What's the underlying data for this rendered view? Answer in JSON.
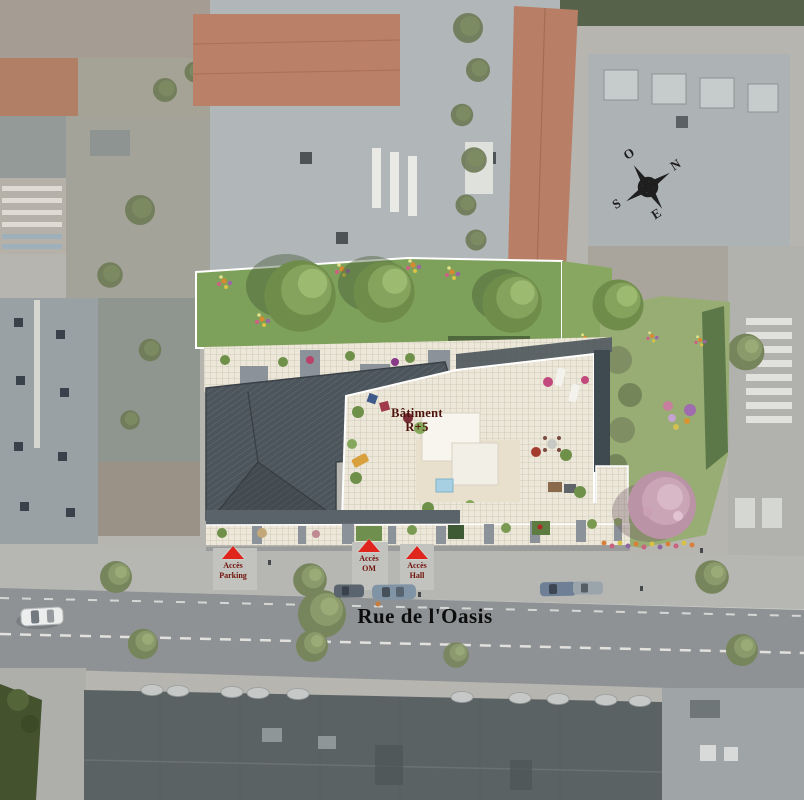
{
  "plan": {
    "building": {
      "label_line1": "Bâtiment",
      "label_line2": "R+5"
    },
    "street": {
      "name": "Rue de l'Oasis"
    },
    "access_points": [
      {
        "id": "parking",
        "line1": "Accès",
        "line2": "Parking"
      },
      {
        "id": "om",
        "line1": "Accès",
        "line2": "OM"
      },
      {
        "id": "hall",
        "line1": "Accès",
        "line2": "Hall"
      }
    ],
    "compass": {
      "north": "N",
      "south": "S",
      "east": "E",
      "west": "O"
    },
    "colors": {
      "lawn_green": "#7da05a",
      "garden_green": "#98ad74",
      "slate_roof": "#4d555c",
      "terrace_tile": "#ece7d9",
      "access_marker_red": "#e0251c",
      "label_dark_red": "#701108",
      "street_gray": "#8e9294",
      "pink_tree": "#c3a0b2",
      "pool_blue": "#a7d0e3"
    }
  }
}
